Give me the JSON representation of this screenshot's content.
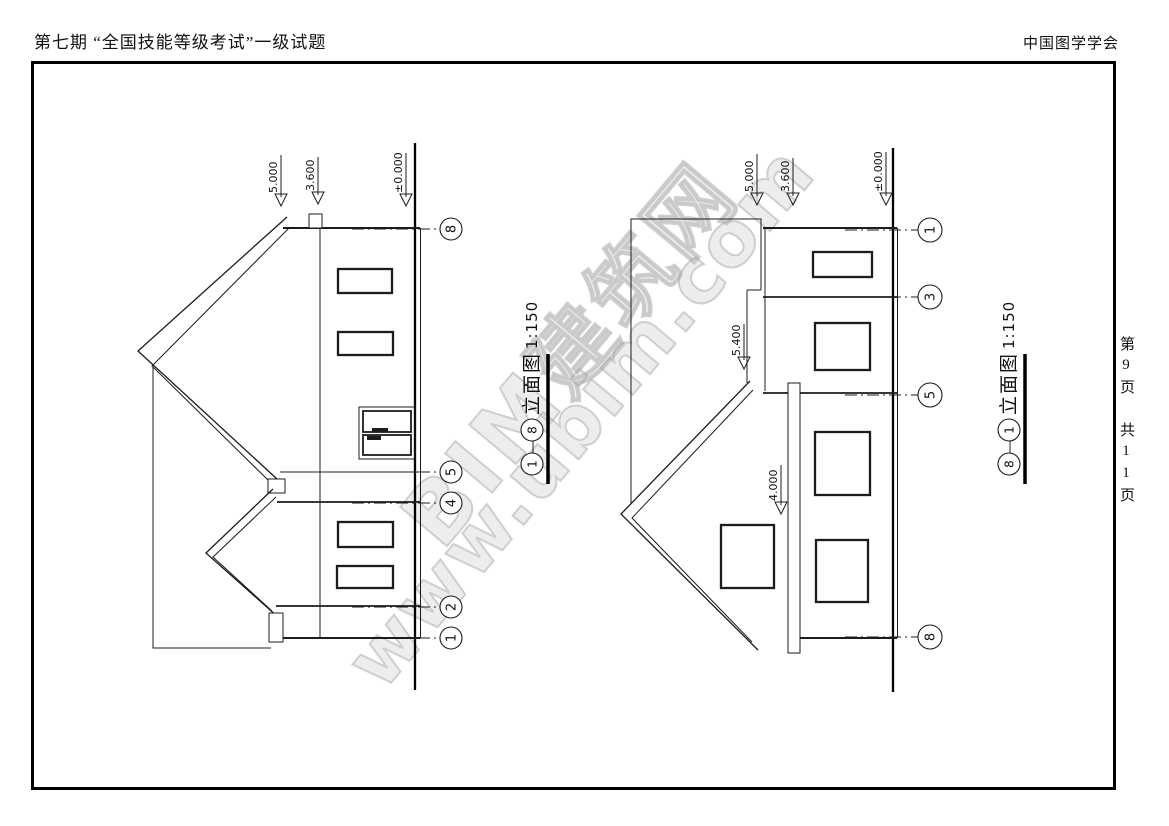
{
  "header": {
    "exam_title": "第七期 “全国技能等级考试”一级试题",
    "organization": "中国图学学会"
  },
  "page_margin": {
    "page_indicator": "第9页 共11页"
  },
  "watermark": {
    "line1": "BIM建筑网",
    "line2": "www.ubim.com"
  },
  "left_view": {
    "marks": [
      {
        "value": "5.000"
      },
      {
        "value": "3.600"
      },
      {
        "value": "±0.000"
      }
    ],
    "bubbles": [
      {
        "n": "8"
      },
      {
        "n": "5"
      },
      {
        "n": "4"
      },
      {
        "n": "2"
      },
      {
        "n": "1"
      }
    ],
    "title": {
      "start_bubble": "1",
      "dash": "—",
      "end_bubble": "8",
      "name": "立面图",
      "scale": "1:150"
    }
  },
  "right_view": {
    "marks": [
      {
        "value": "5.000"
      },
      {
        "value": "3.600"
      },
      {
        "value": "±0.000"
      },
      {
        "value": "5.400"
      },
      {
        "value": "4.000"
      }
    ],
    "bubbles": [
      {
        "n": "1"
      },
      {
        "n": "3"
      },
      {
        "n": "5"
      },
      {
        "n": "8"
      }
    ],
    "title": {
      "start_bubble": "8",
      "dash": "—",
      "end_bubble": "1",
      "name": "立面图",
      "scale": "1:150"
    }
  }
}
